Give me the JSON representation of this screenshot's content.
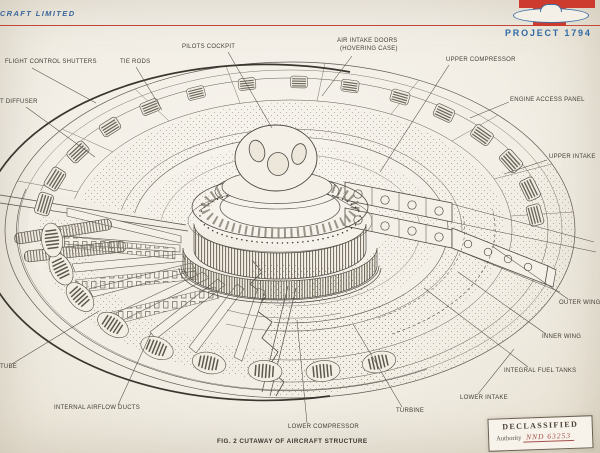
{
  "header": {
    "company": "RCRAFT LIMITED",
    "project": "PROJECT 1794",
    "accent_red": "#c14838",
    "brand_blue": "#2e6aa5"
  },
  "diagram": {
    "labels": [
      {
        "id": "flight-control-shutters",
        "text": "FLIGHT CONTROL SHUTTERS"
      },
      {
        "id": "tie-rods",
        "text": "TIE RODS"
      },
      {
        "id": "pilots-cockpit",
        "text": "PILOTS COCKPIT"
      },
      {
        "id": "air-intake-doors",
        "text": "AIR INTAKE DOORS"
      },
      {
        "id": "air-intake-doors-sub",
        "text": "(HOVERING CASE)"
      },
      {
        "id": "upper-compressor",
        "text": "UPPER COMPRESSOR"
      },
      {
        "id": "engine-access-panel",
        "text": "ENGINE ACCESS PANEL"
      },
      {
        "id": "upper-intake",
        "text": "UPPER INTAKE"
      },
      {
        "id": "outer-wing",
        "text": "OUTER WING"
      },
      {
        "id": "inner-wing",
        "text": "INNER WING"
      },
      {
        "id": "integral-fuel-tanks",
        "text": "INTEGRAL FUEL TANKS"
      },
      {
        "id": "lower-intake",
        "text": "LOWER INTAKE"
      },
      {
        "id": "turbine",
        "text": "TURBINE"
      },
      {
        "id": "lower-compressor",
        "text": "LOWER COMPRESSOR"
      },
      {
        "id": "internal-airflow-ducts",
        "text": "INTERNAL AIRFLOW DUCTS"
      },
      {
        "id": "tube-partial",
        "text": "TUBE"
      },
      {
        "id": "diffuser-partial",
        "text": "T DIFFUSER"
      }
    ],
    "caption": "FIG. 2 CUTAWAY OF AIRCRAFT STRUCTURE"
  },
  "stamp": {
    "line1": "DECLASSIFIED",
    "line2_label": "Authority",
    "line2_value": "NND 63253"
  }
}
